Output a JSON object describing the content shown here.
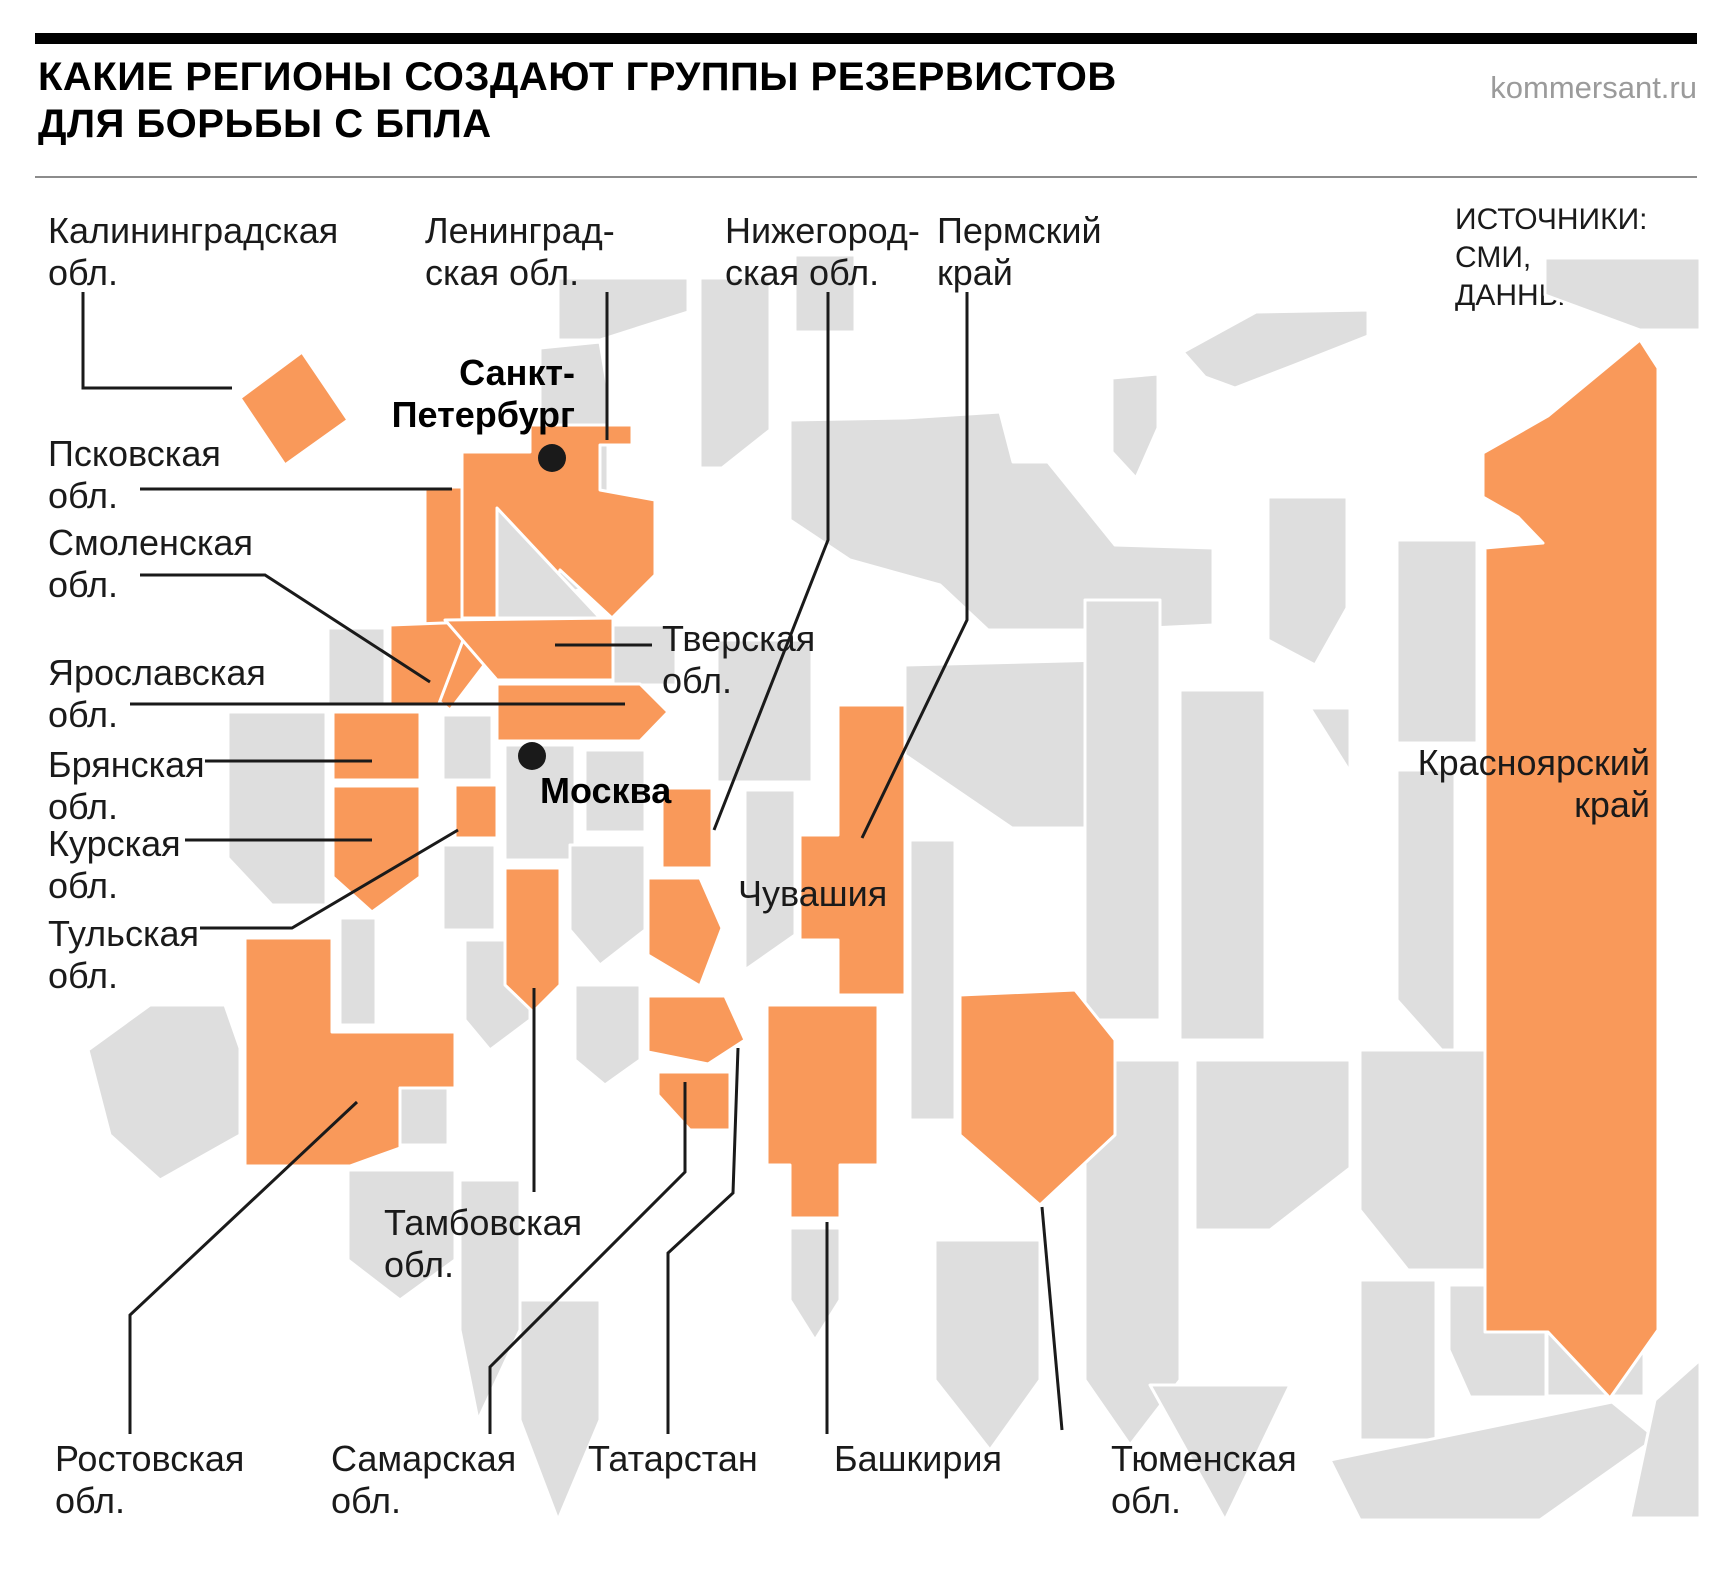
{
  "title": "КАКИЕ РЕГИОНЫ СОЗДАЮТ ГРУППЫ РЕЗЕРВИСТОВ\nДЛЯ БОРЬБЫ С БПЛА",
  "brand": "kommersant.ru",
  "sources": "ИСТОЧНИКИ:\nСМИ,\nДАННЫЕ “Ъ”.",
  "colors": {
    "highlight": "#F9995A",
    "region_base": "#DEDEDE",
    "region_stroke": "#FFFFFF",
    "leader": "#1A1A1A",
    "text": "#1A1A1A",
    "brand_gray": "#9B9B9B"
  },
  "labels": {
    "kaliningrad": "Калининградская\nобл.",
    "leningrad": "Ленинград-\nская обл.",
    "nizhny": "Нижегород-\nская обл.",
    "perm": "Пермский\nкрай",
    "pskov": "Псковская\nобл.",
    "smolensk": "Смоленская\nобл.",
    "yaroslavl": "Ярославская\nобл.",
    "bryansk": "Брянская\nобл.",
    "kursk": "Курская\nобл.",
    "tula": "Тульская\nобл.",
    "tver": "Тверская\nобл.",
    "chuvashia": "Чувашия",
    "krasnoyarsk": "Красноярский\nкрай",
    "tambov": "Тамбовская\nобл.",
    "rostov": "Ростовская\nобл.",
    "samara": "Самарская\nобл.",
    "tatarstan": "Татарстан",
    "bashkiria": "Башкирия",
    "tyumen": "Тюменская\nобл.",
    "spb": "Санкт-\nПетербург",
    "moscow": "Москва"
  },
  "map": {
    "highlighted_regions": [
      "Калининградская обл.",
      "Ленинградская обл.",
      "Псковская обл.",
      "Смоленская обл.",
      "Тверская обл.",
      "Ярославская обл.",
      "Брянская обл.",
      "Курская обл.",
      "Тульская обл.",
      "Нижегородская обл.",
      "Чувашия",
      "Тамбовская обл.",
      "Ростовская обл.",
      "Самарская обл.",
      "Татарстан",
      "Башкирия",
      "Пермский край",
      "Тюменская обл.",
      "Красноярский край"
    ],
    "cities": [
      "Санкт-Петербург",
      "Москва"
    ]
  }
}
